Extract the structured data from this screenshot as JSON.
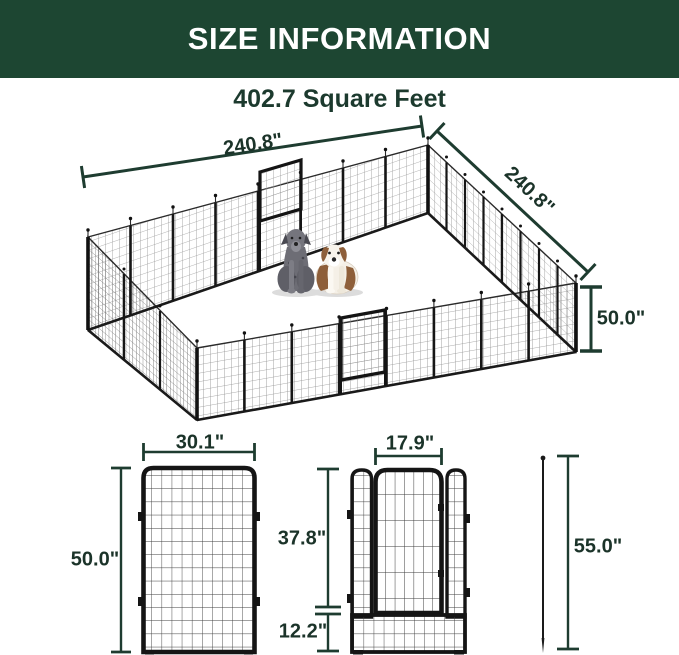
{
  "header": {
    "title": "SIZE INFORMATION"
  },
  "area": {
    "label": "402.7 Square Feet"
  },
  "pen": {
    "dimensions": {
      "top_width": "240.8\"",
      "side_width": "240.8\"",
      "height": "50.0\""
    },
    "contents": [
      "great-dane-dog",
      "saint-bernard-dog"
    ]
  },
  "panel": {
    "width": "30.1\"",
    "height": "50.0\""
  },
  "door_panel": {
    "door_width": "17.9\"",
    "upper_height": "37.8\"",
    "lower_height": "12.2\""
  },
  "stake": {
    "length": "55.0\""
  },
  "colors": {
    "header_bg": "#1d4632",
    "header_text": "#ffffff",
    "dimension_text": "#1b3329",
    "dimension_line": "#1e3c30",
    "mesh_line": "#979797",
    "frame": "#151515"
  }
}
